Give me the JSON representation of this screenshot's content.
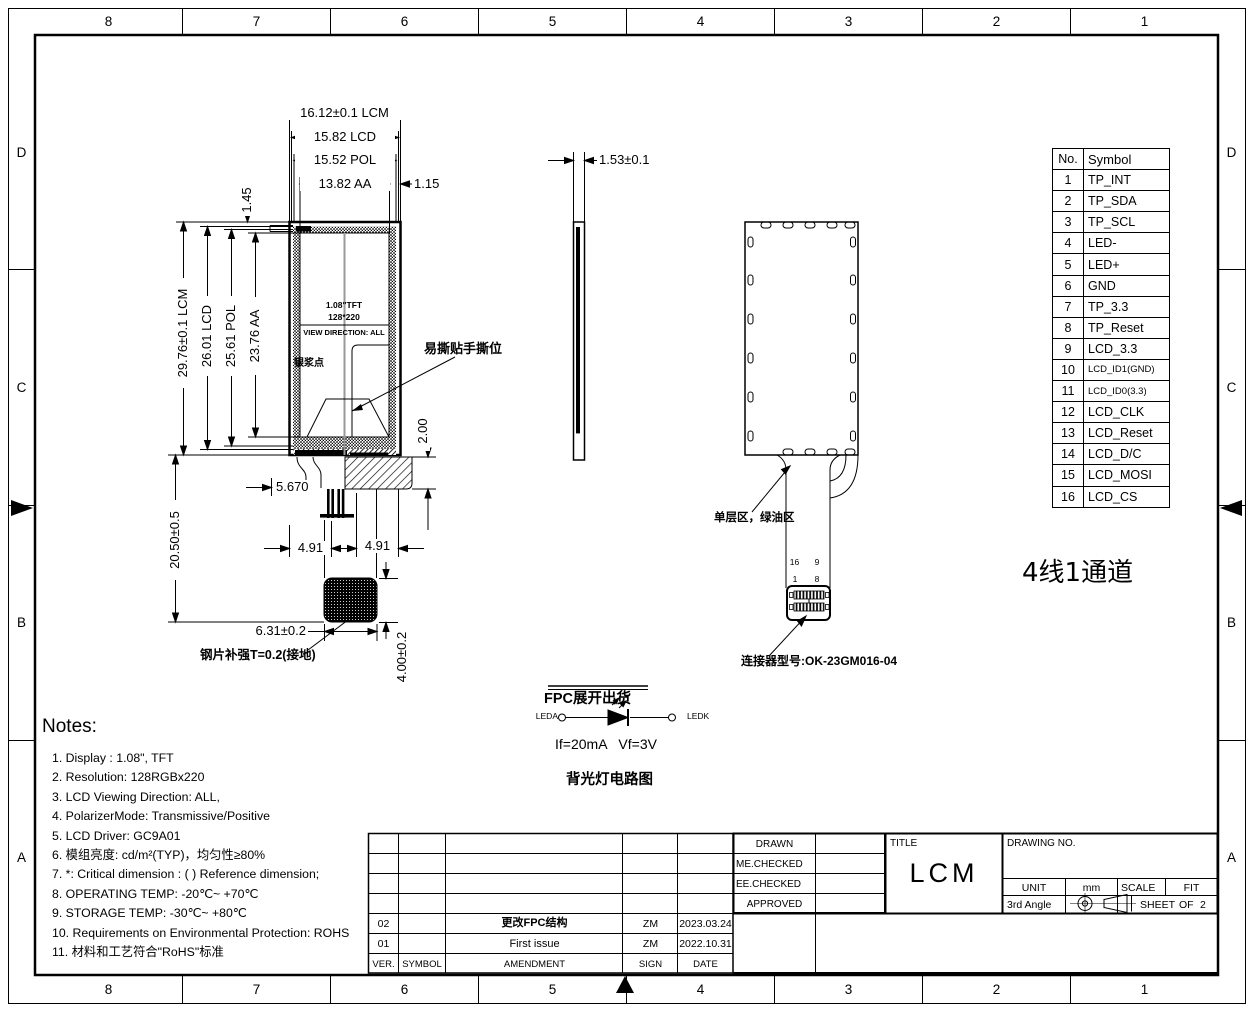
{
  "zones": {
    "columns": [
      "8",
      "7",
      "6",
      "5",
      "4",
      "3",
      "2",
      "1"
    ],
    "rows": [
      "D",
      "C",
      "B",
      "A"
    ]
  },
  "front_view": {
    "dim_lcm_w": "16.12±0.1 LCM",
    "dim_lcd_w": "15.82 LCD",
    "dim_pol_w": "15.52 POL",
    "dim_aa_w": "13.82 AA",
    "dim_offset": "1.15",
    "dim_top_border": "1.45",
    "dim_lcm_h": "29.76±0.1 LCM",
    "dim_lcd_h": "26.01 LCD",
    "dim_pol_h": "25.61 POL",
    "dim_aa_h": "23.76 AA",
    "dim_fpc_len": "20.50±0.5",
    "dim_bottom_border": "2.00",
    "dim_pin": "5.670",
    "dim_left_tail": "4.91",
    "dim_right_tail": "4.91",
    "dim_tail_w": "6.31±0.2",
    "dim_tail_h": "4.00±0.2",
    "screen_size": "1.08\"TFT",
    "screen_res": "128*220",
    "screen_direction": "VIEW DIRECTION: ALL",
    "label_silver_dot": "银浆点",
    "label_tear_tab": "易撕贴手撕位",
    "label_stiffener": "钢片补强T=0.2(接地)"
  },
  "side_view": {
    "dim_thickness": "1.53±0.1"
  },
  "back_view": {
    "label_area": "单层区，绿油区",
    "pin16": "16",
    "pin9": "9",
    "pin1": "1",
    "pin8": "8",
    "label_connector": "连接器型号:OK-23GM016-04"
  },
  "backlight": {
    "fpc_note": "FPC展开出货",
    "anode": "LEDA",
    "cathode": "LEDK",
    "spec": "If=20mA   Vf=3V",
    "caption": "背光灯电路图"
  },
  "channel_note": "4线1通道",
  "pin_table": {
    "header_no": "No.",
    "header_symbol": "Symbol",
    "rows": [
      {
        "no": "1",
        "symbol": "TP_INT"
      },
      {
        "no": "2",
        "symbol": "TP_SDA"
      },
      {
        "no": "3",
        "symbol": "TP_SCL"
      },
      {
        "no": "4",
        "symbol": "LED-"
      },
      {
        "no": "5",
        "symbol": "LED+"
      },
      {
        "no": "6",
        "symbol": "GND"
      },
      {
        "no": "7",
        "symbol": "TP_3.3"
      },
      {
        "no": "8",
        "symbol": "TP_Reset"
      },
      {
        "no": "9",
        "symbol": "LCD_3.3"
      },
      {
        "no": "10",
        "symbol": "LCD_ID1(GND)"
      },
      {
        "no": "11",
        "symbol": "LCD_ID0(3.3)"
      },
      {
        "no": "12",
        "symbol": "LCD_CLK"
      },
      {
        "no": "13",
        "symbol": "LCD_Reset"
      },
      {
        "no": "14",
        "symbol": "LCD_D/C"
      },
      {
        "no": "15",
        "symbol": "LCD_MOSI"
      },
      {
        "no": "16",
        "symbol": "LCD_CS"
      }
    ]
  },
  "notes": {
    "title": "Notes:",
    "items": [
      "1. Display : 1.08\",  TFT",
      "2. Resolution: 128RGBx220",
      "3. LCD Viewing Direction: ALL,",
      "4. PolarizerMode: Transmissive/Positive",
      "5. LCD Driver: GC9A01",
      "6. 模组亮度: cd/m²(TYP)，均匀性≥80%",
      "7. *: Critical dimension : ( ) Reference dimension;",
      "8. OPERATING TEMP: -20℃~ +70℃",
      "9. STORAGE TEMP: -30℃~ +80℃",
      "10. Requirements on Environmental Protection: ROHS",
      "11. 材料和工艺符合\"RoHS\"标准"
    ]
  },
  "revision_table": {
    "header": {
      "ver": "VER.",
      "symbol": "SYMBOL",
      "amendment": "AMENDMENT",
      "sign": "SIGN",
      "date": "DATE"
    },
    "rows": [
      {
        "ver": "02",
        "symbol": "",
        "amendment": "更改FPC结构",
        "sign": "ZM",
        "date": "2023.03.24"
      },
      {
        "ver": "01",
        "symbol": "",
        "amendment": "First issue",
        "sign": "ZM",
        "date": "2022.10.31"
      }
    ]
  },
  "approval": {
    "rows": [
      "DRAWN",
      "ME.CHECKED",
      "EE.CHECKED",
      "APPROVED"
    ]
  },
  "title_block": {
    "title_label": "TITLE",
    "title": "LCM",
    "drawing_no_label": "DRAWING NO.",
    "unit_label": "UNIT",
    "unit_value": "mm",
    "scale_label": "SCALE",
    "scale_value": "FIT",
    "angle_label": "3rd Angle",
    "sheet_label": "SHEET",
    "sheet_of": "OF",
    "sheet_value": "2"
  }
}
